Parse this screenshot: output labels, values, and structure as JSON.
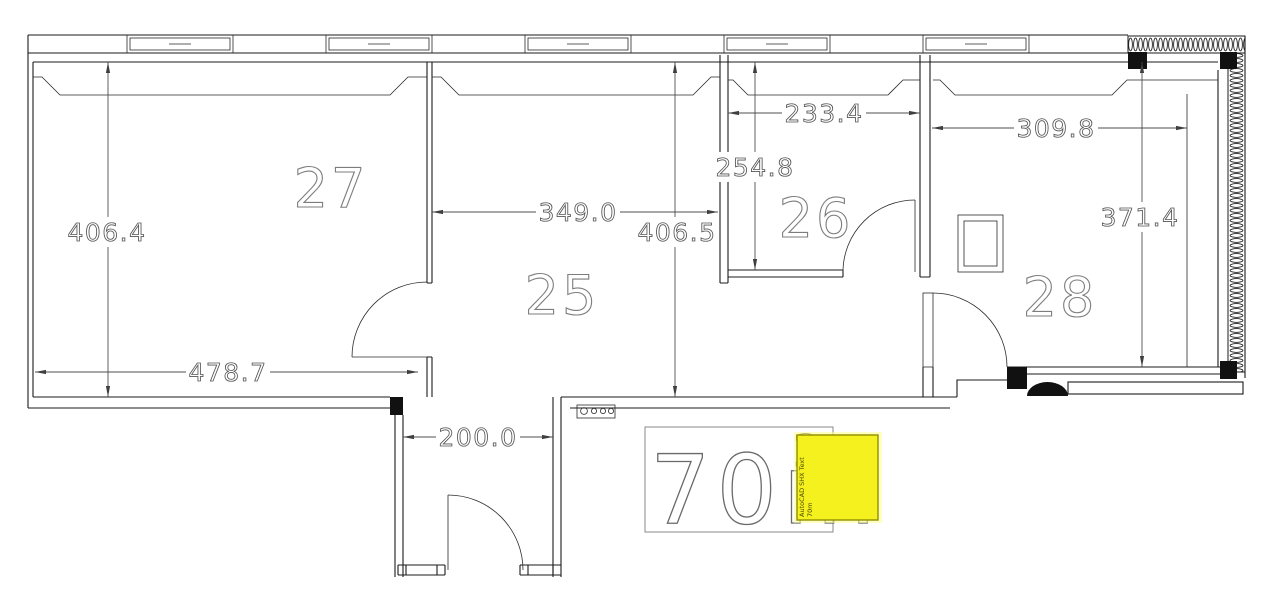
{
  "rooms": [
    {
      "number": "27"
    },
    {
      "number": "25"
    },
    {
      "number": "26"
    },
    {
      "number": "28"
    }
  ],
  "dimensions": {
    "room27_height": "406.4",
    "room27_width": "478.7",
    "room25_width": "349.0",
    "room25_height": "406.5",
    "room26_width": "233.4",
    "room26_height": "254.8",
    "room28_width": "309.8",
    "room28_height": "371.4",
    "entry_width": "200.0"
  },
  "area_label": {
    "value": "70m",
    "exponent": "2"
  },
  "highlight": {
    "tool_label": "AutoCAD SHX Text",
    "value_label": "70m",
    "fill": "#f5f11e"
  },
  "colors": {
    "line": "#1b1b1b",
    "dim": "#4f4f4f",
    "label": "#7c7c7c"
  }
}
